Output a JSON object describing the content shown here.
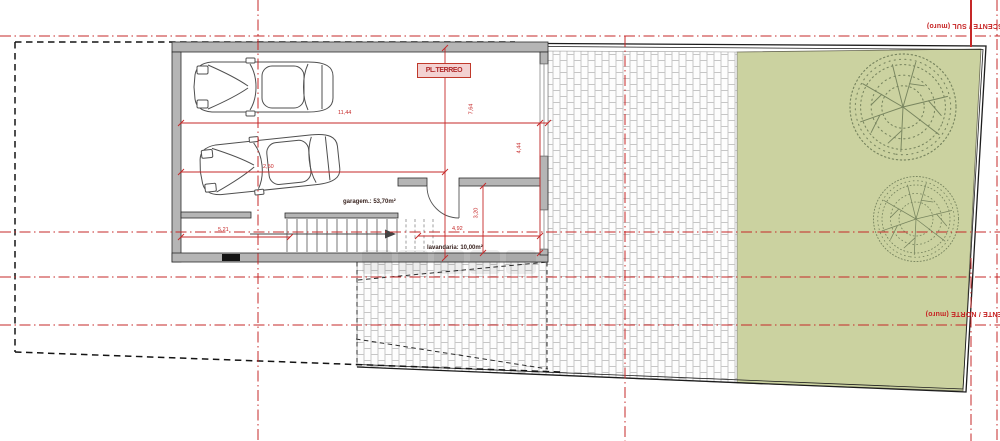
{
  "plan": {
    "stamp_label": "PL.TERREO",
    "rooms": {
      "garage": "garagem.: 53,70m²",
      "laundry": "lavandaria: 10,00m²"
    },
    "dimensions": {
      "garage_width": "11,44",
      "car_bay": "2,50",
      "garage_depth": "7,64",
      "right_depth": "4,44",
      "stair_width": "5,21",
      "laundry_width": "4,92",
      "laundry_depth": "3,20"
    },
    "boundary_labels": {
      "south_wall": "ASCENTE / SUL (muro)",
      "north_wall": "OENTE / NORTE (muro)"
    },
    "colors": {
      "centerline_red": "#c62828",
      "garden_green": "#cbd2a0",
      "wall_gray": "#b5b5b5",
      "tree_green": "#78855f"
    }
  }
}
